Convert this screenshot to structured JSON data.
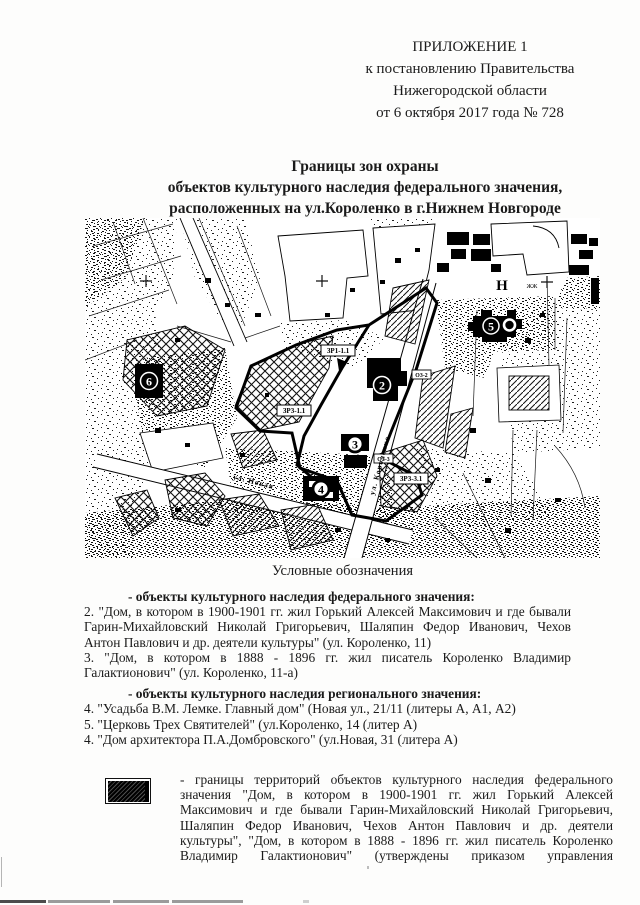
{
  "palette": {
    "ink": "#1a1a1a",
    "paper": "#fdfdfc"
  },
  "header": {
    "lines": [
      "ПРИЛОЖЕНИЕ 1",
      "к постановлению Правительства",
      "Нижегородской области",
      "от 6 октября 2017 года № 728"
    ]
  },
  "title": {
    "lines": [
      "Границы зон охраны",
      "объектов культурного наследия федерального значения,",
      "расположенных на ул.Короленко в г.Нижнем Новгороде"
    ]
  },
  "map": {
    "markers": [
      {
        "num": "2"
      },
      {
        "num": "3"
      },
      {
        "num": "4"
      },
      {
        "num": "5"
      },
      {
        "num": "6"
      }
    ],
    "zone_labels": [
      {
        "text": "ЗР1-1.1"
      },
      {
        "text": "ЗР3-1.1"
      },
      {
        "text": "ЗР3-3.1"
      },
      {
        "text": "ОЗ-2"
      },
      {
        "text": "ОЗ-3"
      }
    ],
    "streets": [
      {
        "name": "ул. Новая"
      },
      {
        "name": "ул. Короленко"
      }
    ],
    "annotations": {
      "block_letter": "Н",
      "block_note": "ЖЖ"
    }
  },
  "legend": {
    "caption": "Условные обозначения",
    "federal": {
      "heading": "- объекты культурного наследия федерального значения:",
      "items": [
        "2. \"Дом, в котором в 1900-1901 гг. жил Горький Алексей Максимович и где бывали Гарин-Михайловский Николай Григорьевич, Шаляпин Федор Иванович, Чехов Антон Павлович и др. деятели культуры\" (ул. Короленко, 11)",
        "3. \"Дом, в котором в 1888 - 1896 гг. жил писатель Короленко Владимир Галактионович\" (ул. Короленко, 11-а)"
      ]
    },
    "regional": {
      "heading": "- объекты культурного наследия регионального значения:",
      "items": [
        "4. \"Усадьба В.М. Лемке. Главный дом\" (Новая ул., 21/11 (литеры А, А1, А2)",
        "5. \"Церковь Трех Святителей\" (ул.Короленко, 14 (литер А)",
        "4. \"Дом архитектора П.А.Домбровского\" (ул.Новая, 31 (литера А)"
      ]
    }
  },
  "boundary_note": {
    "text": "- границы территорий объектов культурного наследия федерального значения \"Дом, в котором в 1900-1901 гг. жил Горький Алексей Максимович и где бывали Гарин-Михайловский Николай Григорьевич, Шаляпин Федор Иванович, Чехов Антон Павлович и др. деятели культуры\", \"Дом, в котором в 1888 - 1896 гг. жил писатель Короленко Владимир Галактионович\" (утверждены приказом управления"
  }
}
